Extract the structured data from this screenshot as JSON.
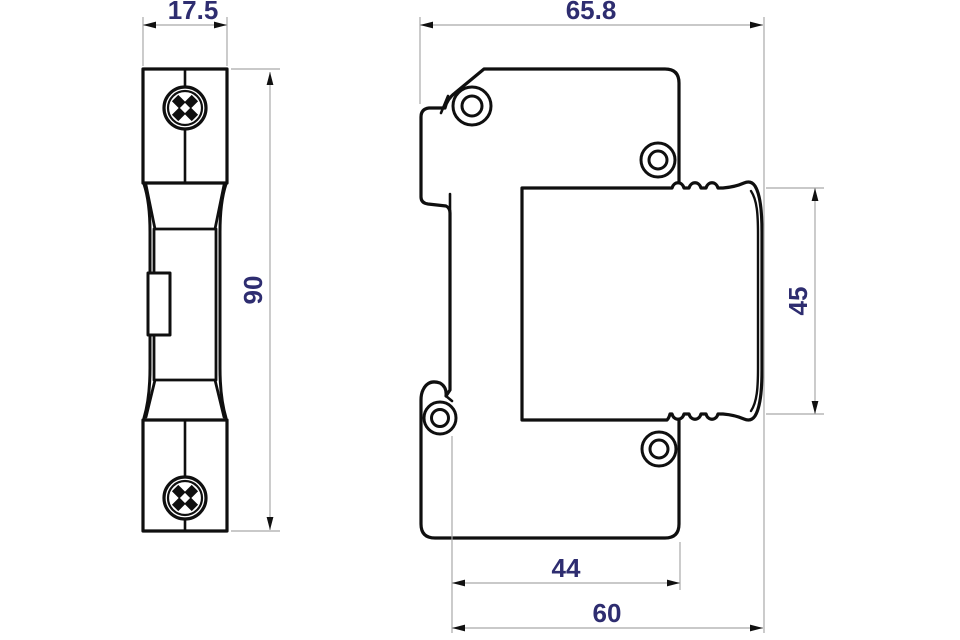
{
  "drawing": {
    "kind": "technical-dimension-drawing",
    "views": {
      "front": {
        "label_count": 2
      },
      "side": {
        "label_count": 4
      }
    }
  },
  "dimensions": {
    "front_width": "17.5",
    "front_height": "90",
    "side_width": "65.8",
    "module_height": "45",
    "mounting_width": "44",
    "base_width": "60"
  },
  "colors": {
    "outline": "#0f0f0f",
    "dimension_line": "#a9a9a9",
    "arrow": "#111111",
    "dimension_text": "#2e2d70",
    "background": "#ffffff"
  }
}
